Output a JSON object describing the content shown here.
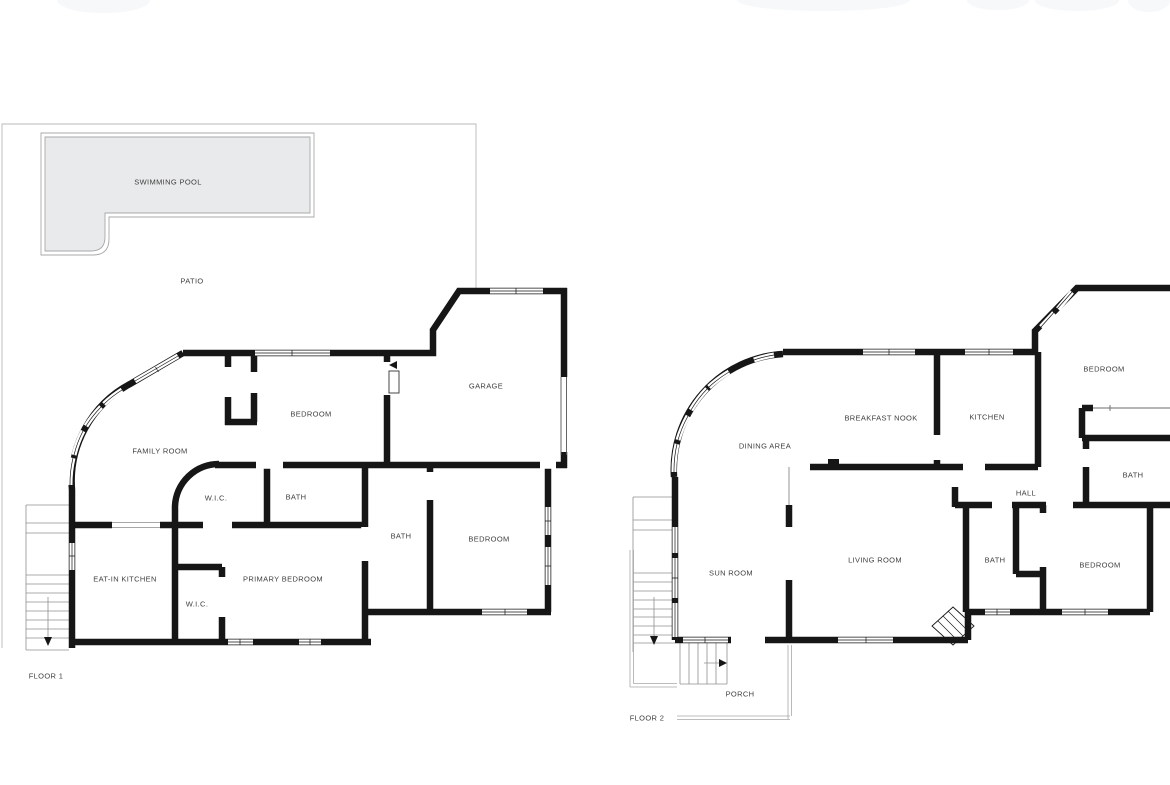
{
  "canvas": {
    "width": 1170,
    "height": 785
  },
  "colors": {
    "wall": "#161616",
    "pool_fill": "#e9eaeb",
    "thin_outline": "#a8a8a8",
    "stair_line": "#909090",
    "label_text": "#3f3f3f",
    "background": "#ffffff"
  },
  "floor1": {
    "floor_label": {
      "text": "FLOOR 1",
      "x": 46,
      "y": 676
    },
    "rooms": [
      {
        "label": "SWIMMING POOL",
        "x": 168,
        "y": 182
      },
      {
        "label": "PATIO",
        "x": 192,
        "y": 281
      },
      {
        "label": "GARAGE",
        "x": 486,
        "y": 386
      },
      {
        "label": "BEDROOM",
        "x": 311,
        "y": 414
      },
      {
        "label": "FAMILY ROOM",
        "x": 160,
        "y": 451
      },
      {
        "label": "W.I.C.",
        "x": 216,
        "y": 498
      },
      {
        "label": "BATH",
        "x": 296,
        "y": 497
      },
      {
        "label": "BATH",
        "x": 401,
        "y": 536
      },
      {
        "label": "BEDROOM",
        "x": 489,
        "y": 539
      },
      {
        "label": "EAT-IN KITCHEN",
        "x": 125,
        "y": 579
      },
      {
        "label": "PRIMARY BEDROOM",
        "x": 283,
        "y": 579
      },
      {
        "label": "W.I.C.",
        "x": 197,
        "y": 604
      }
    ]
  },
  "floor2": {
    "floor_label": {
      "text": "FLOOR 2",
      "x": 647,
      "y": 718
    },
    "rooms": [
      {
        "label": "BREAKFAST NOOK",
        "x": 881,
        "y": 418
      },
      {
        "label": "KITCHEN",
        "x": 987,
        "y": 417
      },
      {
        "label": "BEDROOM",
        "x": 1104,
        "y": 369
      },
      {
        "label": "DINING AREA",
        "x": 765,
        "y": 446
      },
      {
        "label": "BATH",
        "x": 1133,
        "y": 475
      },
      {
        "label": "HALL",
        "x": 1026,
        "y": 493
      },
      {
        "label": "SUN ROOM",
        "x": 731,
        "y": 573
      },
      {
        "label": "LIVING ROOM",
        "x": 875,
        "y": 560
      },
      {
        "label": "BATH",
        "x": 995,
        "y": 560
      },
      {
        "label": "BEDROOM",
        "x": 1100,
        "y": 565
      },
      {
        "label": "PORCH",
        "x": 740,
        "y": 694
      }
    ]
  }
}
